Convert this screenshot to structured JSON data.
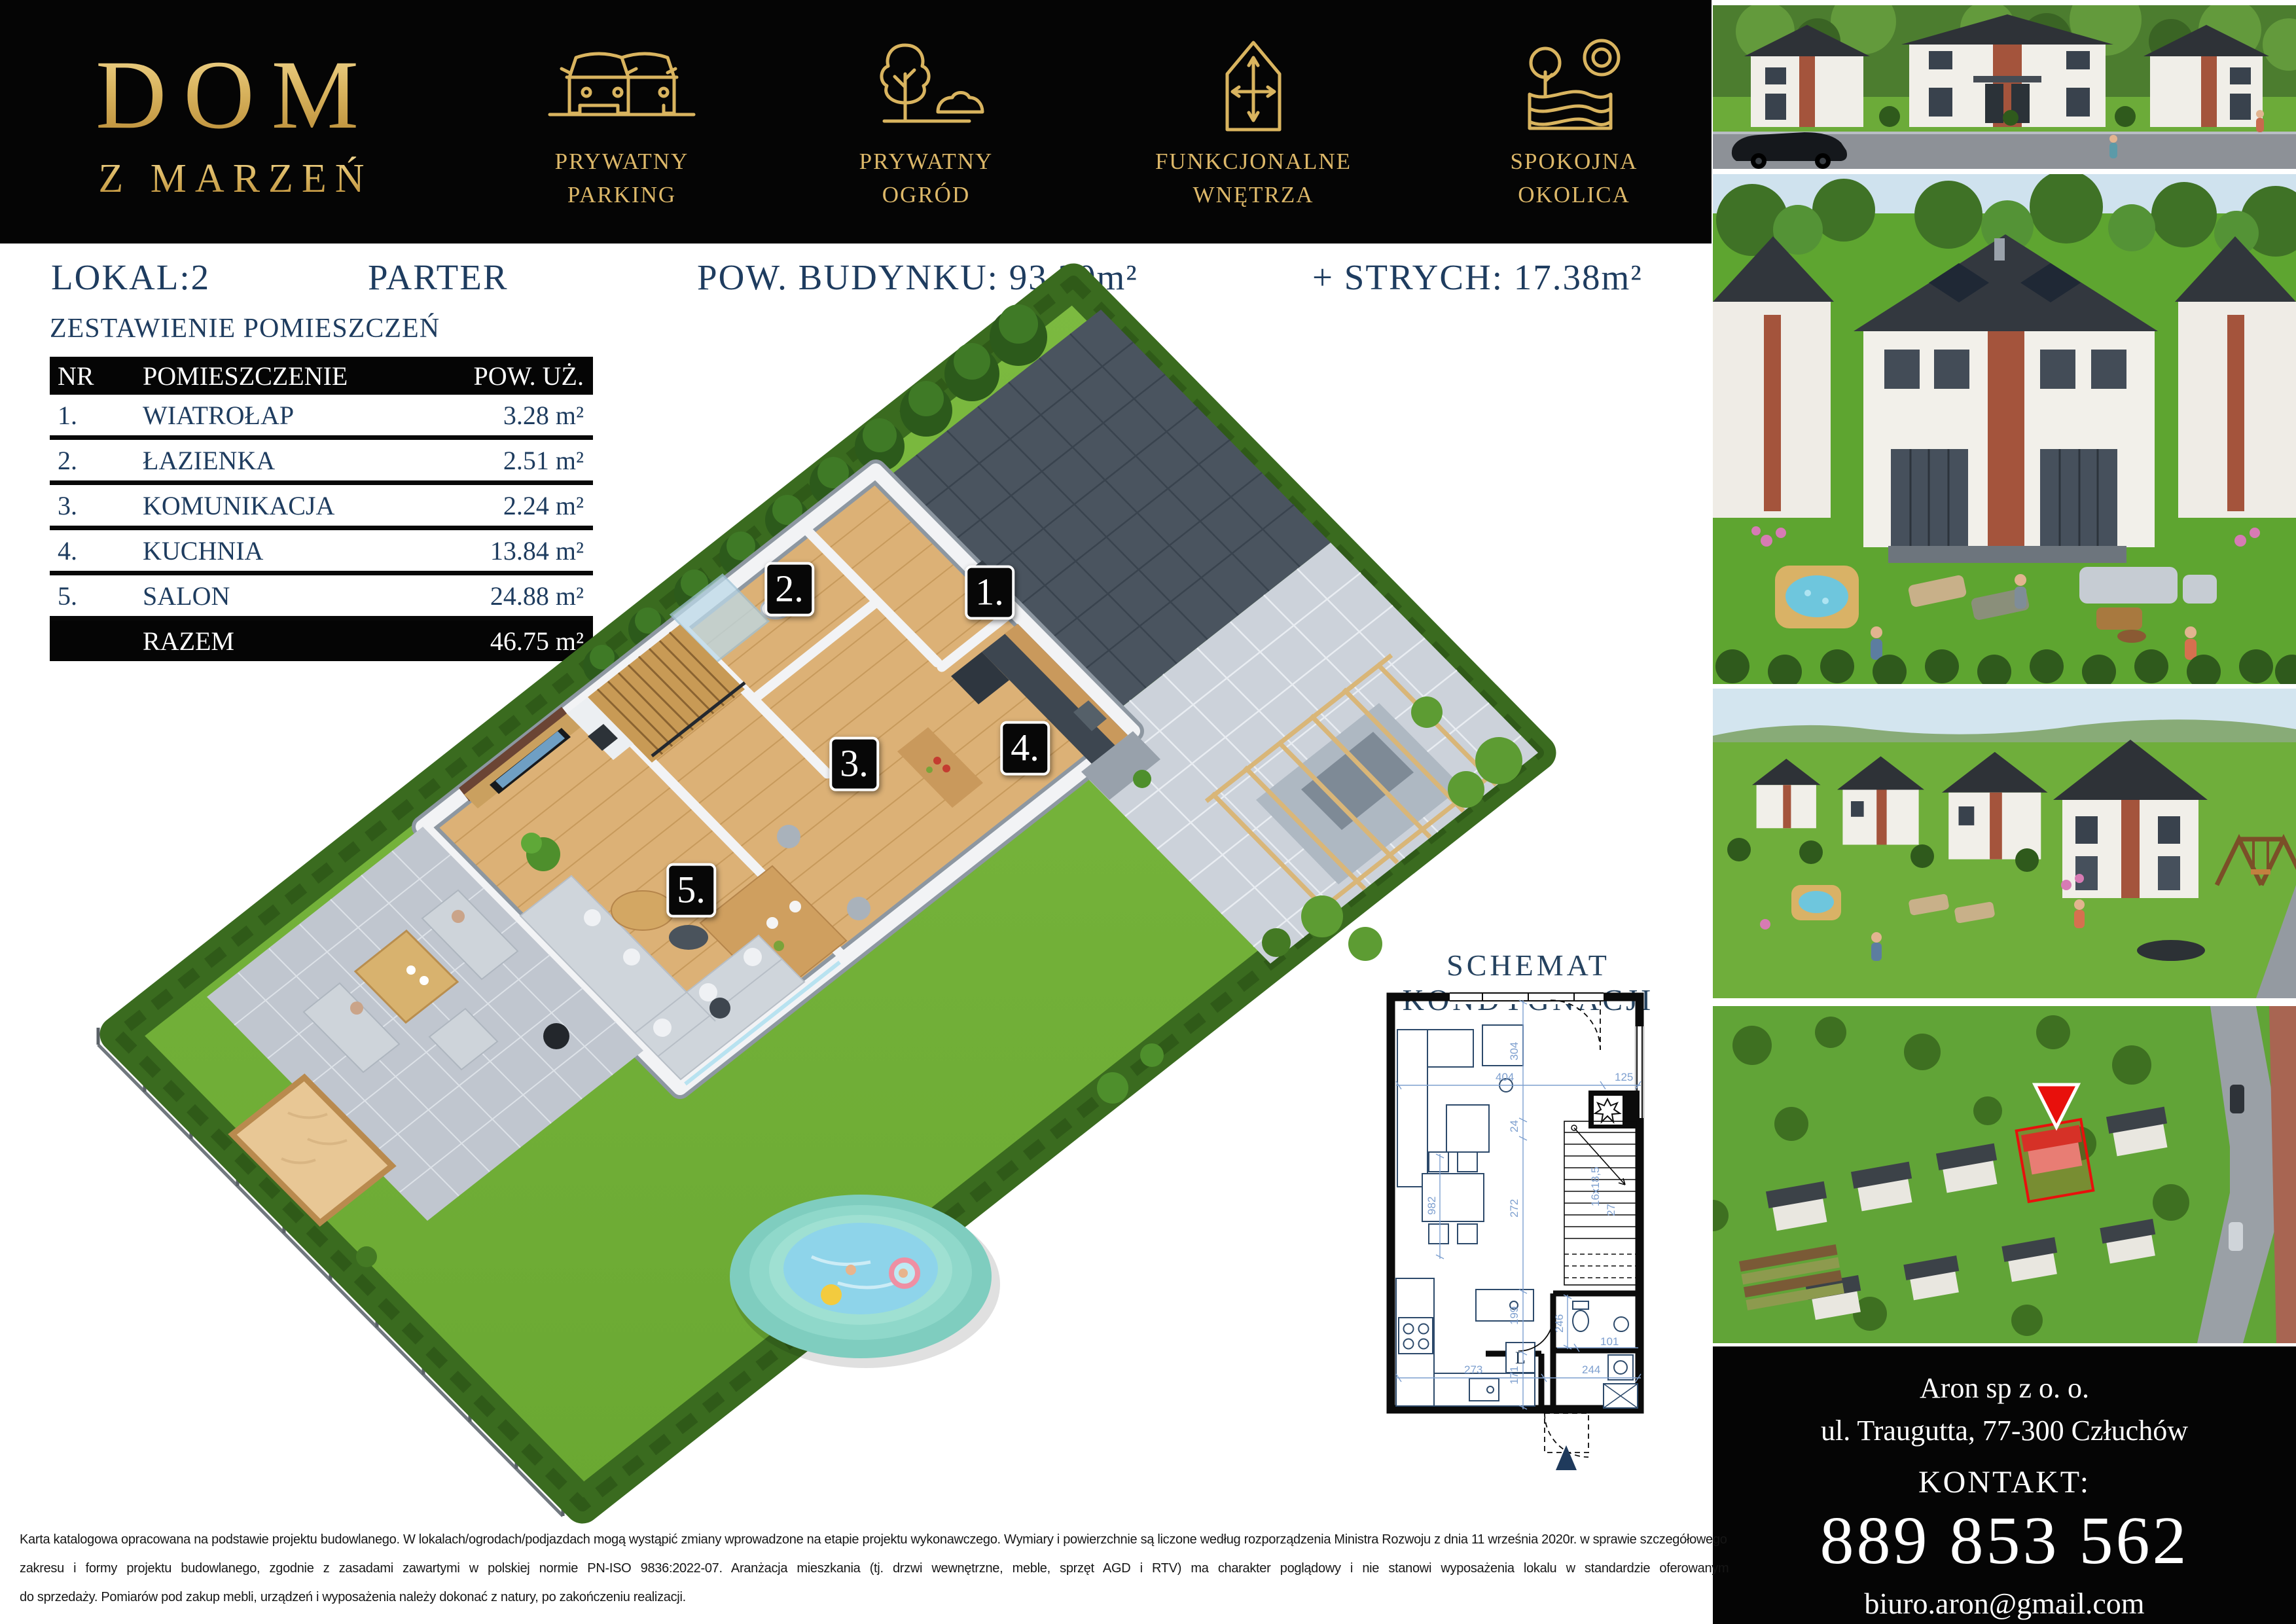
{
  "header": {
    "logo1": "DOM",
    "logo2": "Z MARZEŃ",
    "features": [
      {
        "line1": "PRYWATNY",
        "line2": "PARKING"
      },
      {
        "line1": "PRYWATNY",
        "line2": "OGRÓD"
      },
      {
        "line1": "FUNKCJONALNE",
        "line2": "WNĘTRZA"
      },
      {
        "line1": "SPOKOJNA",
        "line2": "OKOLICA"
      }
    ]
  },
  "info": {
    "lokal": "LOKAL:2",
    "floor": "PARTER",
    "building_area": "POW. BUDYNKU: 93.30m²",
    "attic": "+ STRYCH: 17.38m²"
  },
  "table": {
    "title": "ZESTAWIENIE POMIESZCZEŃ",
    "h_nr": "NR",
    "h_name": "POMIESZCZENIE",
    "h_area": "POW. UŻ.",
    "rows": [
      {
        "nr": "1.",
        "name": "WIATROŁAP",
        "area": "3.28 m²"
      },
      {
        "nr": "2.",
        "name": "ŁAZIENKA",
        "area": "2.51 m²"
      },
      {
        "nr": "3.",
        "name": "KOMUNIKACJA",
        "area": "2.24 m²"
      },
      {
        "nr": "4.",
        "name": "KUCHNIA",
        "area": "13.84 m²"
      },
      {
        "nr": "5.",
        "name": "SALON",
        "area": "24.88 m²"
      }
    ],
    "total_label": "RAZEM",
    "total_area": "46.75 m²"
  },
  "schematic": {
    "title": "SCHEMAT KONDYGNACJI",
    "dims": [
      "404",
      "125",
      "304",
      "24",
      "272",
      "982",
      "199",
      "246",
      "171",
      "101",
      "244",
      "273"
    ],
    "stairs1": "16x18,5",
    "stairs2": "27",
    "fridge": "L"
  },
  "contact": {
    "company": "Aron sp z o. o.",
    "address": "ul. Traugutta, 77-300 Człuchów",
    "contact_label": "KONTAKT:",
    "phone": "889 853 562",
    "email": "biuro.aron@gmail.com",
    "website": "domy-marzen.pl"
  },
  "disclaimer": {
    "l1": "Karta katalogowa opracowana na podstawie projektu budowlanego. W lokalach/ogrodach/podjazdach mogą wystąpić zmiany wprowadzone na etapie projektu wykonawczego. Wymiary i powierzchnie są liczone według rozporządzenia Ministra Rozwoju z dnia 11 września 2020r.  w sprawie szczegółowego",
    "l2": "zakresu i formy projektu budowlanego, zgodnie z zasadami zawartymi w polskiej normie PN-ISO 9836:2022-07. Aranżacja mieszkania (tj. drzwi wewnętrzne, meble, sprzęt AGD i RTV) ma charakter poglądowy i nie stanowi wyposażenia lokalu w standardzie oferowanym",
    "l3": "do sprzedaży. Pomiarów pod zakup mebli, urządzeń i wyposażenia należy dokonać z natury, po zakończeniu realizacji."
  },
  "colors": {
    "gold": "#d9b45f",
    "navy": "#1e3c5f",
    "marker_red": "#e8100c"
  }
}
